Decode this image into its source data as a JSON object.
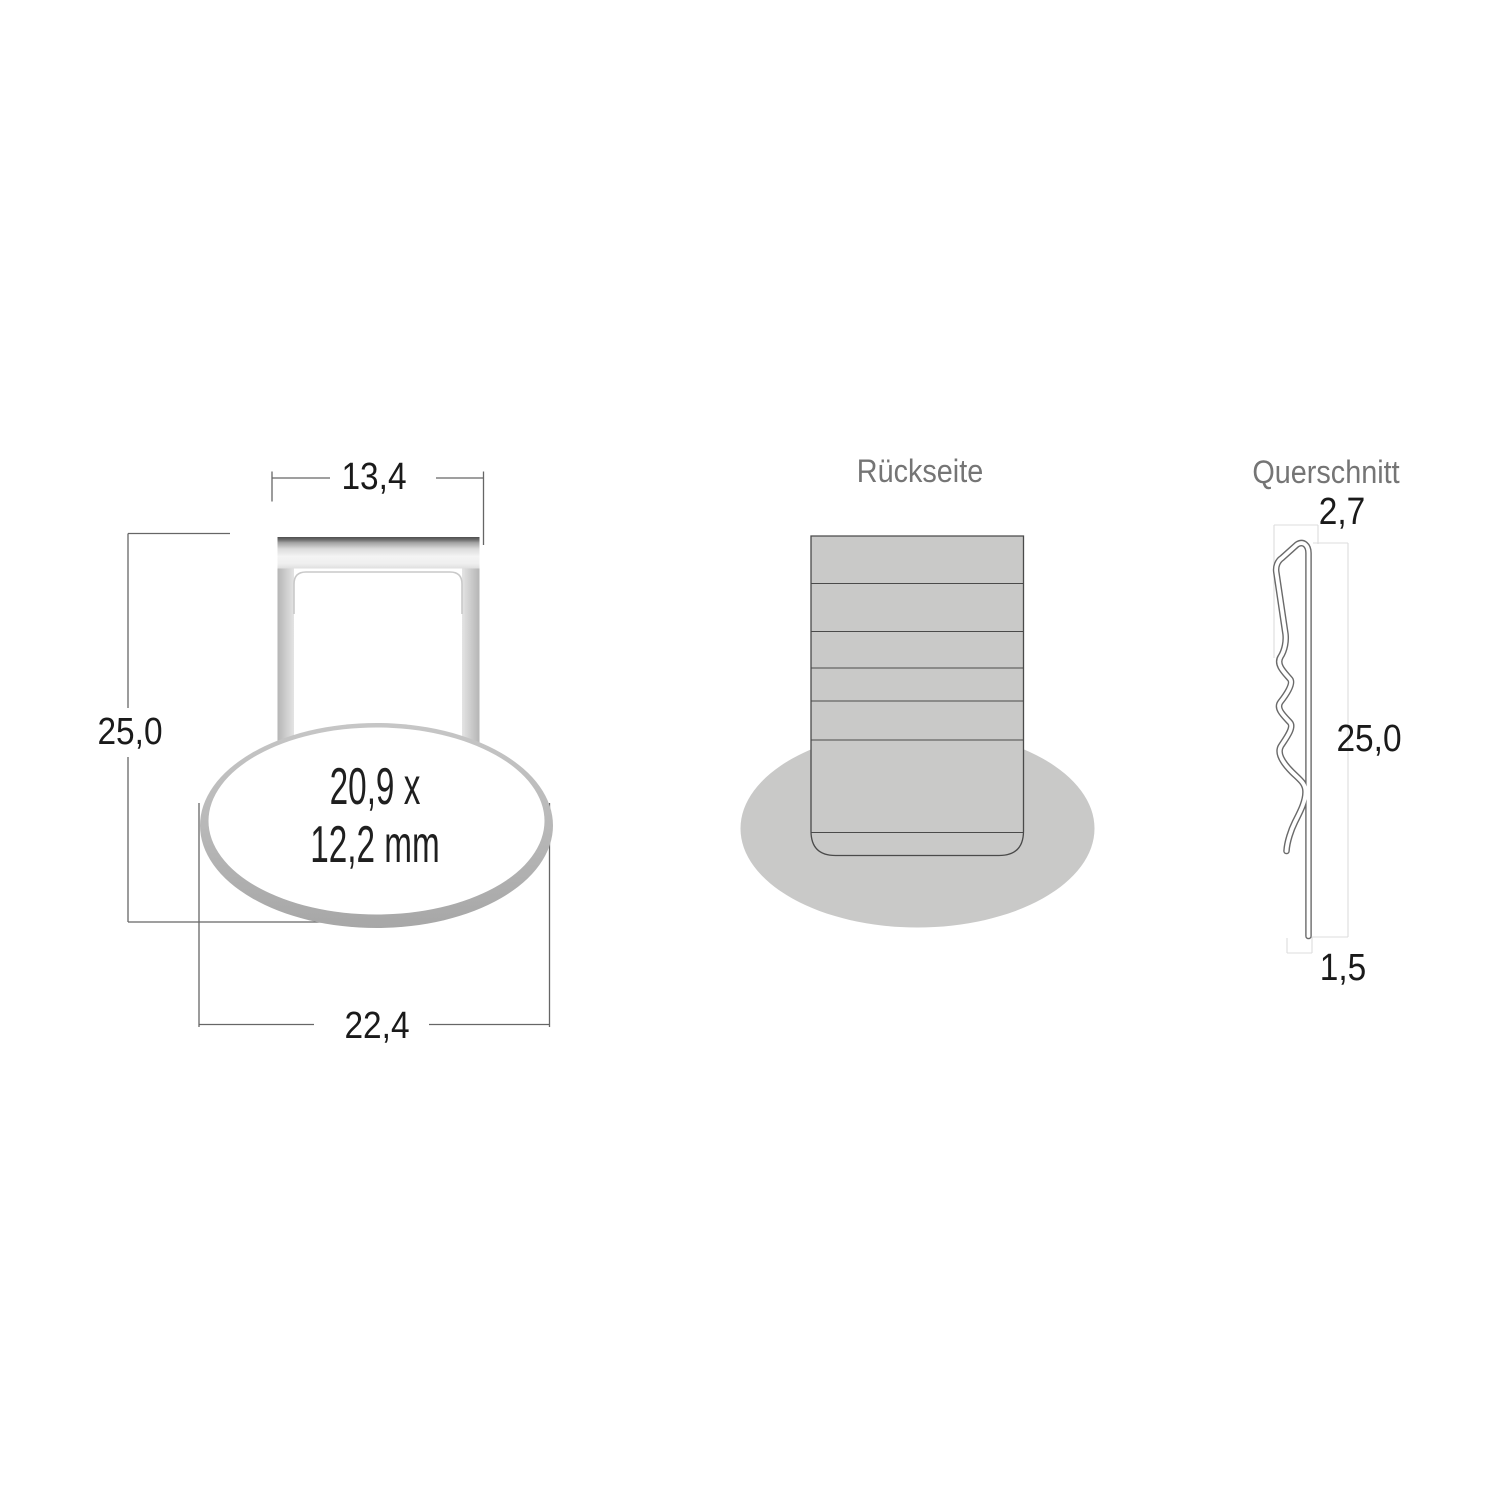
{
  "front_view": {
    "dim_width_top": "13,4",
    "dim_height": "25,0",
    "dim_width_bottom": "22,4",
    "oval_label_line1": "20,9 x",
    "oval_label_line2": "12,2 mm"
  },
  "back_view": {
    "title": "Rückseite"
  },
  "cross_section": {
    "title": "Querschnitt",
    "dim_top_thickness": "2,7",
    "dim_height": "25,0",
    "dim_bottom_thickness": "1,5"
  },
  "colors": {
    "background": "#ffffff",
    "dimension_text": "#1a1a1a",
    "dimension_line": "#666666",
    "title_text": "#757575",
    "back_fill_gray": "#c9c9c8",
    "back_outline": "#4a4a4a",
    "metal_dark": "#505050",
    "metal_light": "#f4f4f4",
    "ring_light": "#c6c6c6",
    "ring_dark": "#a7a7a7",
    "profile_outline": "#6a6a6a",
    "guide_line": "#dcdcdd"
  }
}
